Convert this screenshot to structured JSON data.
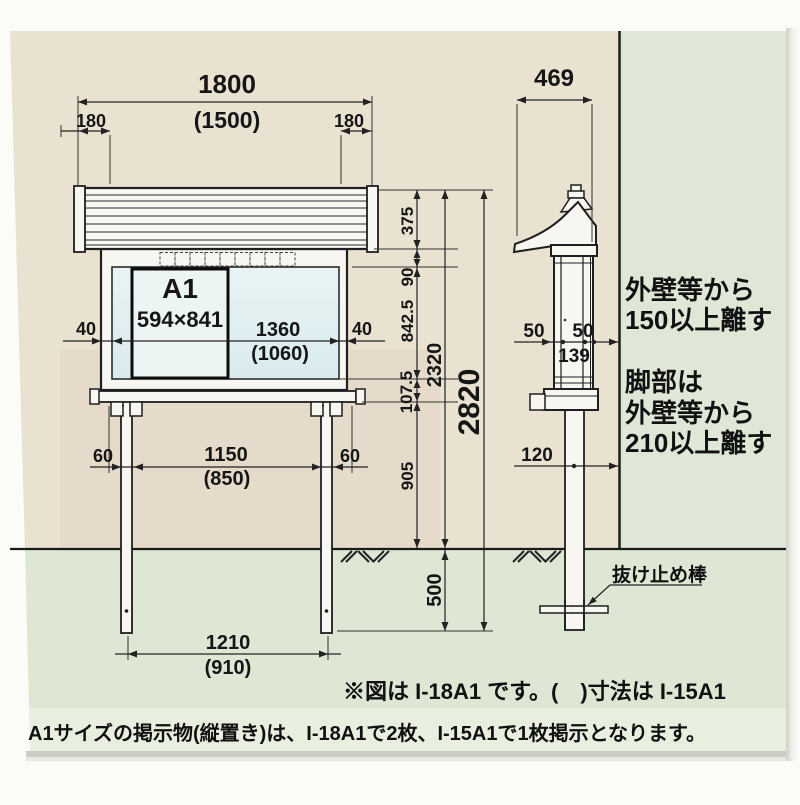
{
  "front": {
    "roof_width": "1800",
    "roof_width_sub": "(1500)",
    "overhang_left": "180",
    "overhang_right": "180",
    "sheet_title": "A1",
    "sheet_size": "594×841",
    "opening_width": "1360",
    "opening_width_sub": "(1060)",
    "frame_left": "40",
    "frame_right": "40",
    "post_width_left": "60",
    "post_span": "1150",
    "post_span_sub": "(850)",
    "post_width_right": "60",
    "anchor_span": "1210",
    "anchor_span_sub": "(910)",
    "roof_height": "375",
    "top_frame_height": "90",
    "opening_height": "842.5",
    "bottom_frame_height": "107.5",
    "post_height": "905",
    "above_ground_height": "2320",
    "buried_depth": "500",
    "total_height": "2820"
  },
  "side": {
    "depth": "469",
    "front_offset": "50",
    "back_offset": "50",
    "body_depth": "139",
    "post_depth": "120",
    "stopper_label": "抜け止め棒",
    "wall_clearance_note": [
      "外壁等から",
      "150以上離す"
    ],
    "leg_clearance_note": [
      "脚部は",
      "外壁等から",
      "210以上離す"
    ]
  },
  "notes": {
    "model_note": "※図は I-18A1 です。(　)寸法は I-15A1",
    "capacity_note": "A1サイズの掲示物(縦置き)は、I-18A1で2枚、I-15A1で1枚掲示となります。"
  },
  "colors": {
    "paper_beige": "#e9e2d1",
    "wall_green": "#dfe7d6",
    "note_band_green": "#e9efdf",
    "board_glass": "#e2eff1",
    "line_black": "#1f1f1f"
  }
}
